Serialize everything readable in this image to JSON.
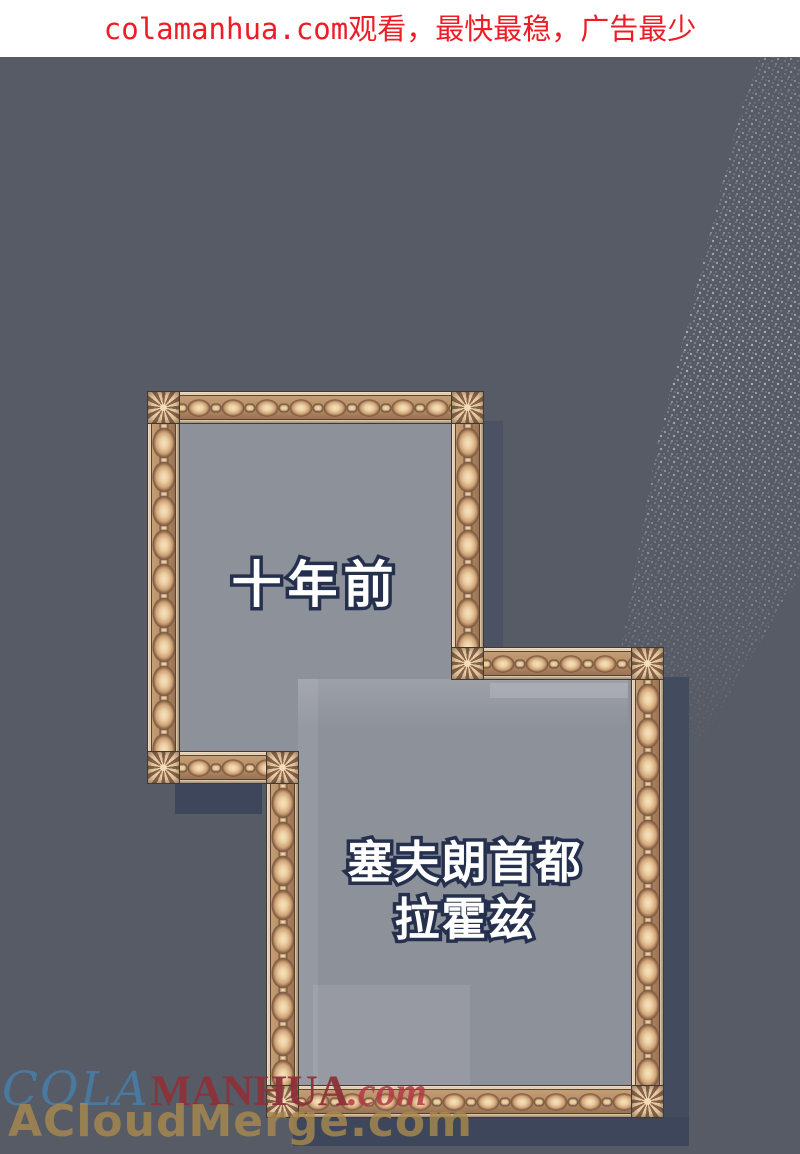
{
  "header": {
    "text": "colamanhua.com观看，最快最稳，广告最少",
    "text_color": "#ee1c25",
    "background": "#ffffff"
  },
  "panels": {
    "panel1_caption": "十年前",
    "panel2_caption_line1": "塞夫朗首都",
    "panel2_caption_line2": "拉霍兹",
    "caption_fill": "#ffffff",
    "caption_outline": "#25304e",
    "canvas_color": "#8d9199"
  },
  "watermarks": {
    "site_script": "COLA",
    "site_serif": "MANHUA",
    "site_suffix": ".com",
    "site_script_color": "#4a7ca6",
    "site_serif_color": "#8d3139",
    "mirror": "ACloudMerge.com",
    "mirror_color": "#a8894f"
  },
  "scene": {
    "background_color": "#565b65",
    "shadow_color": "#3d465b",
    "frame_gold_light": "#efdcc0",
    "frame_gold_mid": "#b68d66",
    "frame_gold_dark": "#7b573f"
  }
}
